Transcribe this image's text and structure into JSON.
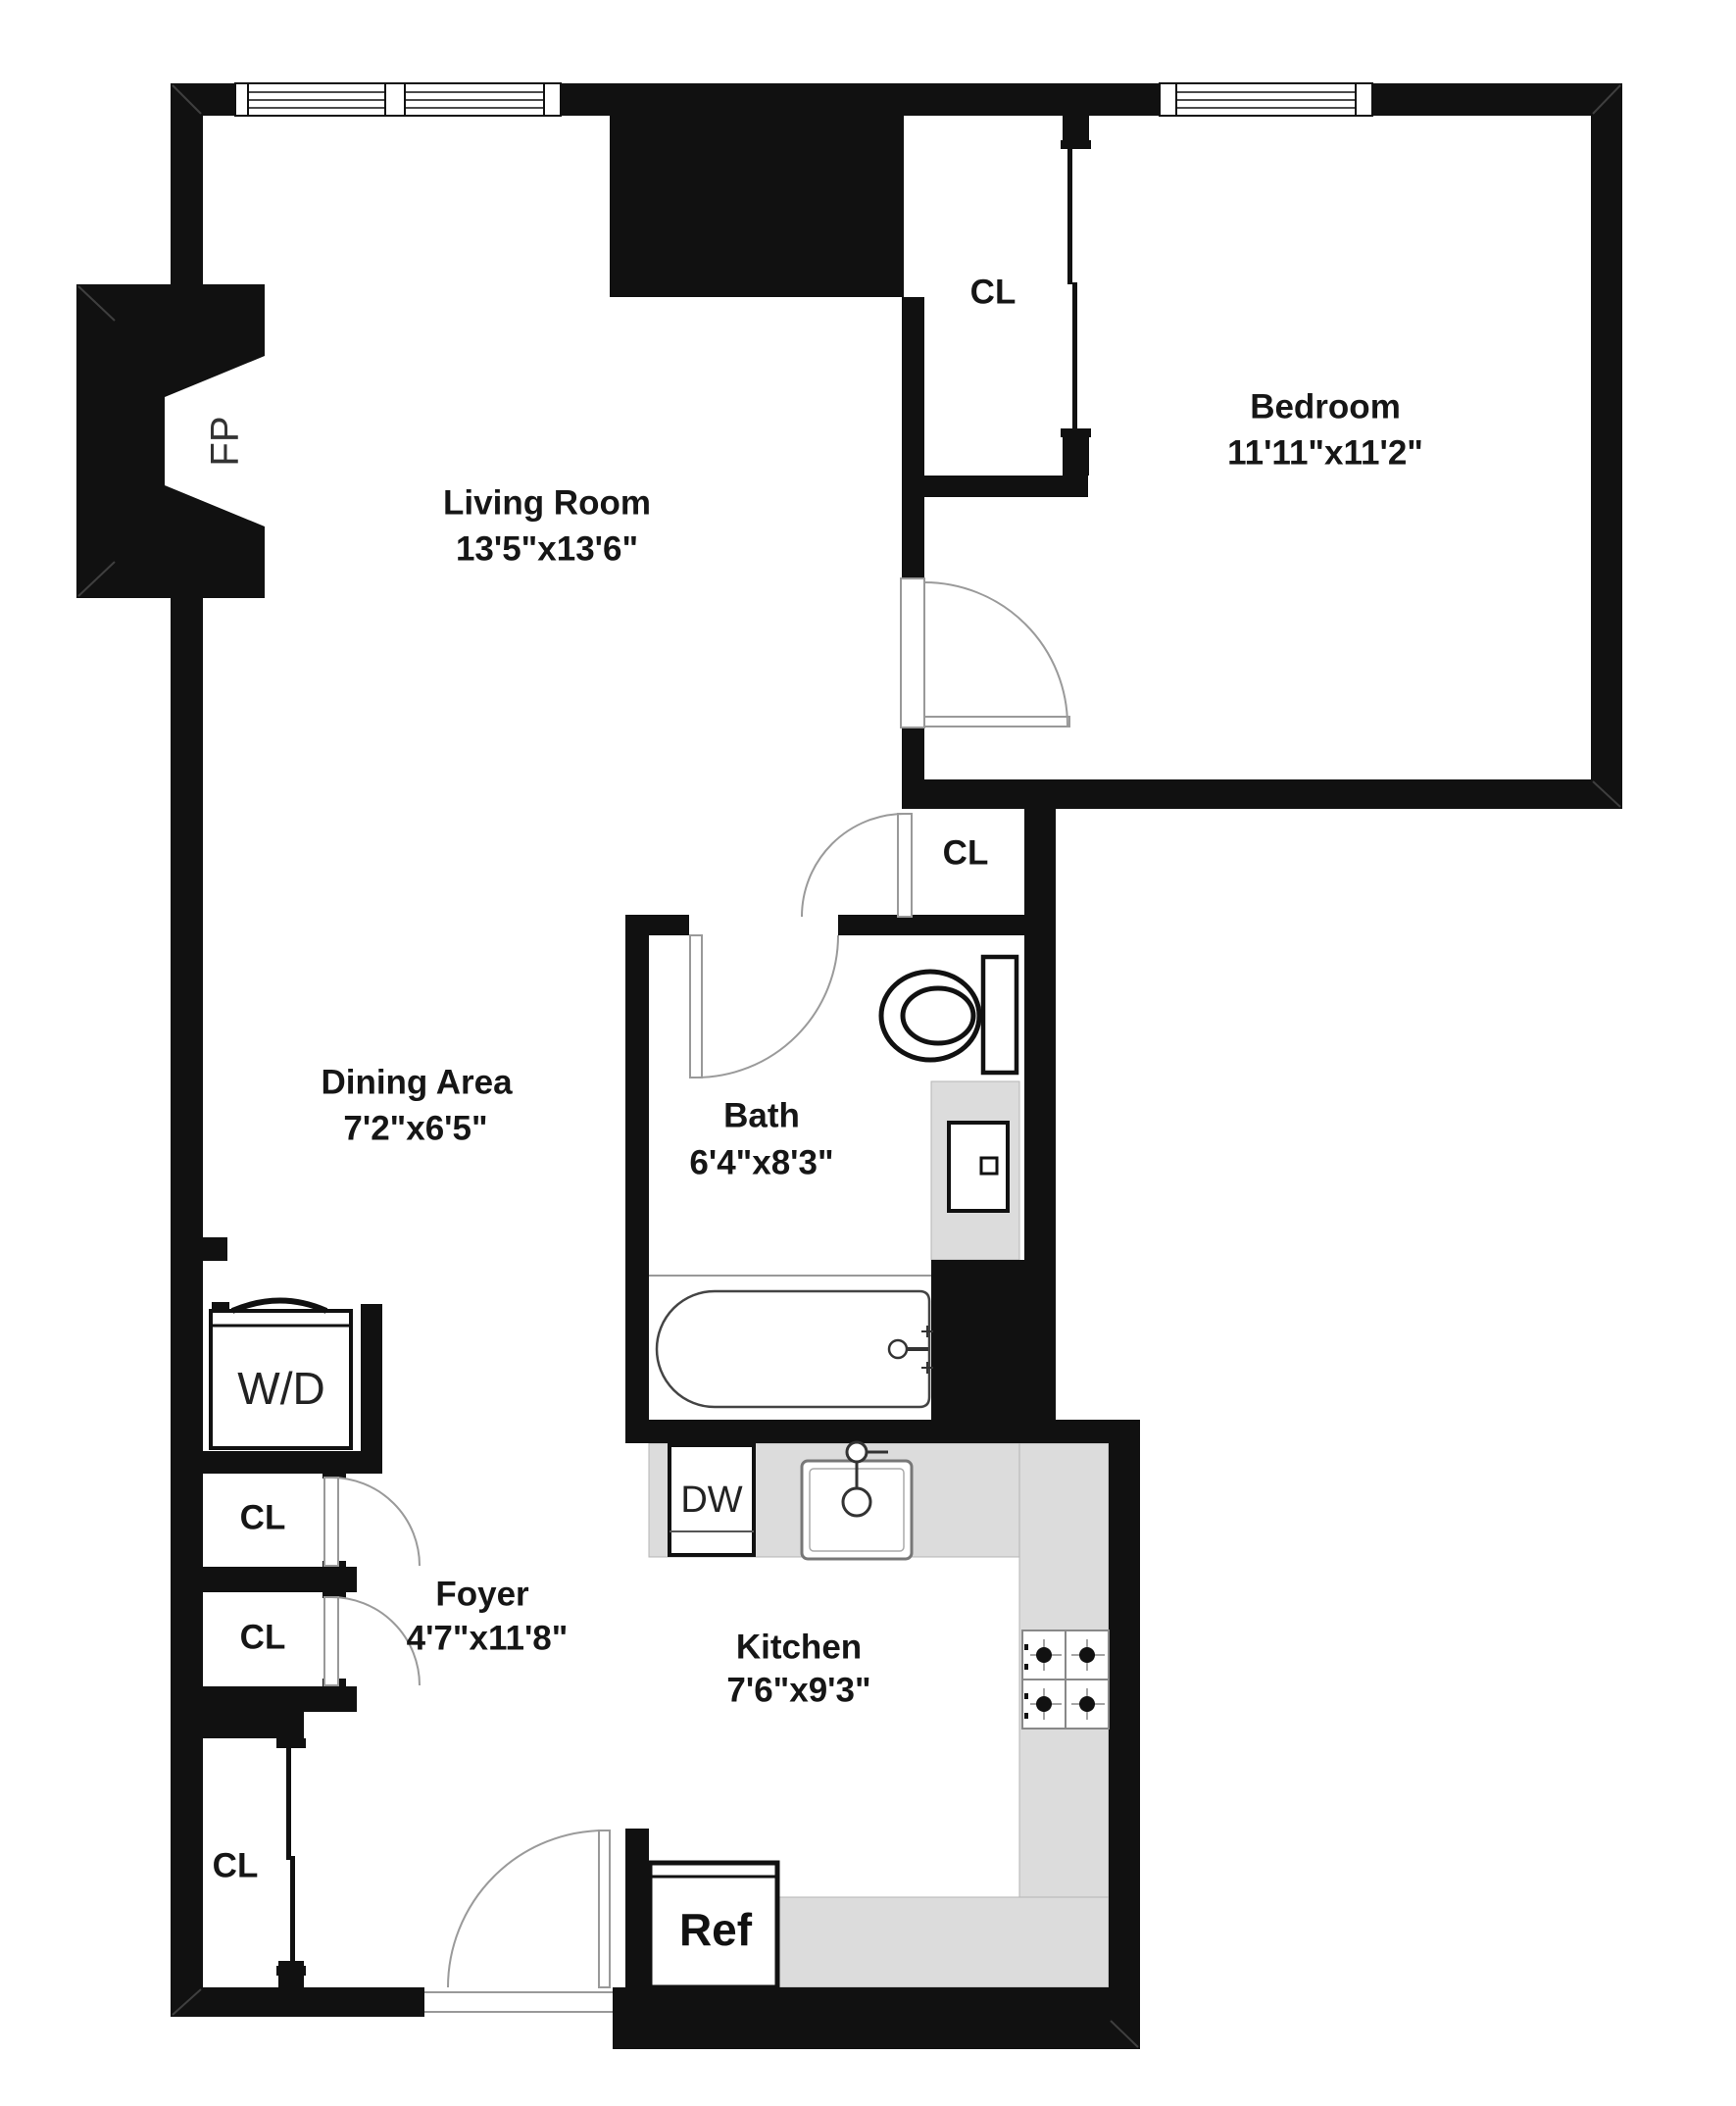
{
  "plan": {
    "rooms": {
      "living_room": {
        "name": "Living Room",
        "dims": "13'5\"x13'6\""
      },
      "bedroom": {
        "name": "Bedroom",
        "dims": "11'11\"x11'2\""
      },
      "dining_area": {
        "name": "Dining Area",
        "dims": "7'2\"x6'5\""
      },
      "bath": {
        "name": "Bath",
        "dims": "6'4\"x8'3\""
      },
      "kitchen": {
        "name": "Kitchen",
        "dims": "7'6\"x9'3\""
      },
      "foyer": {
        "name": "Foyer",
        "dims": "4'7\"x11'8\""
      }
    },
    "labels": {
      "closet": "CL",
      "washer_dryer": "W/D",
      "dishwasher": "DW",
      "refrigerator": "Ref",
      "fireplace": "FP"
    },
    "colors": {
      "wall": "#111111",
      "counter": "#dcdcdc",
      "text": "#161616",
      "background": "#ffffff"
    }
  }
}
